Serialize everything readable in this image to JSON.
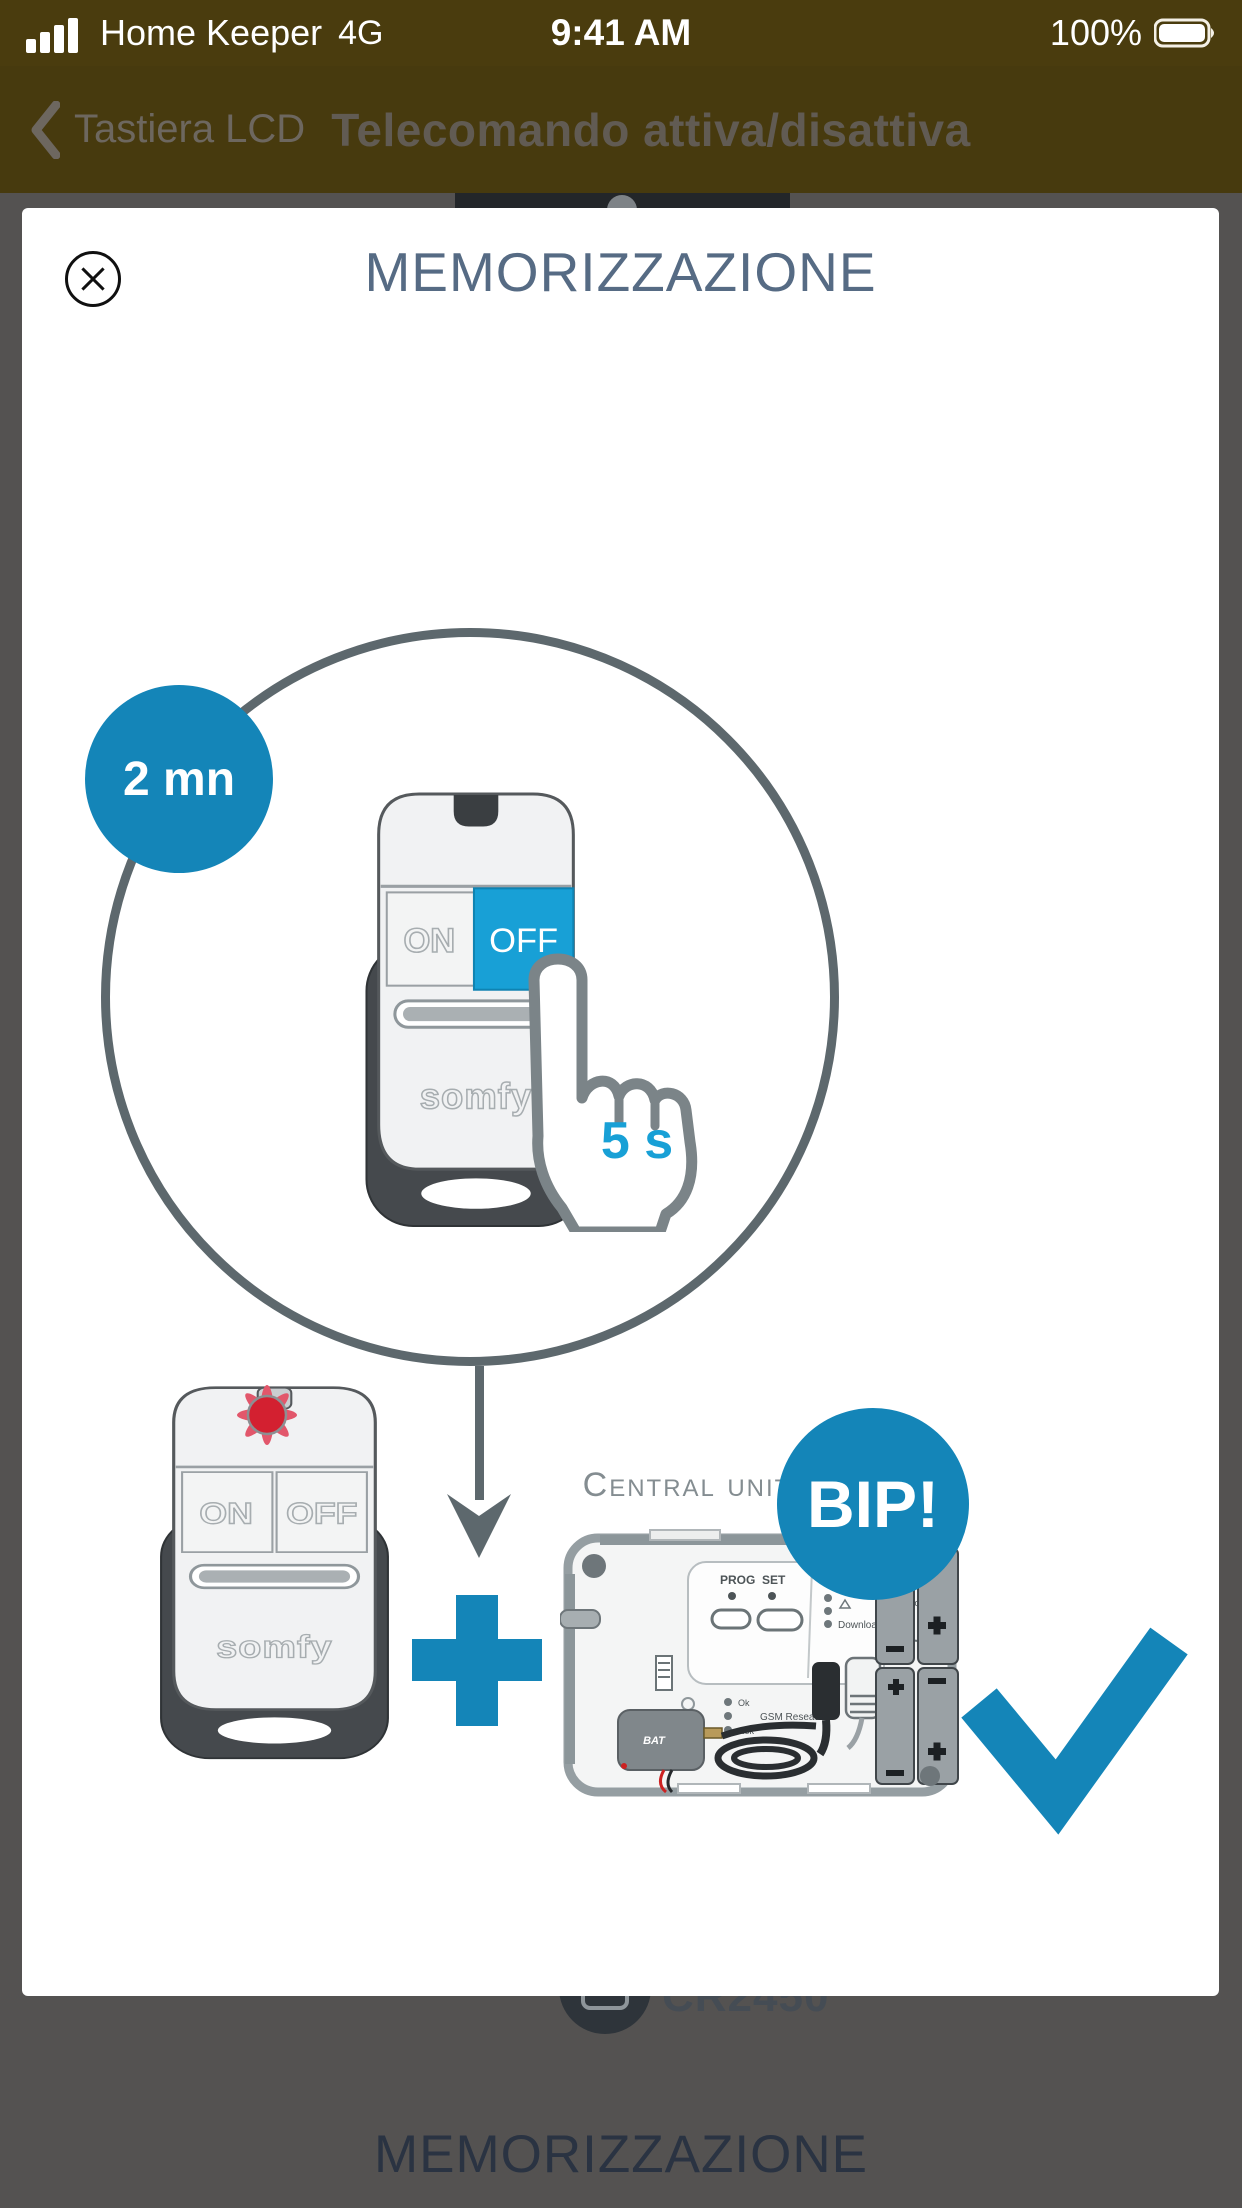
{
  "status_bar": {
    "carrier": "Home Keeper",
    "network": "4G",
    "time": "9:41 AM",
    "battery_percent": "100%"
  },
  "nav_bar": {
    "back_label": "Tastiera LCD",
    "title": "Telecomando attiva/disattiva"
  },
  "modal": {
    "title": "MEMORIZZAZIONE",
    "timer_badge": "2 mn",
    "hold_duration": "5 s",
    "remote_top": {
      "on": "ON",
      "off": "OFF",
      "brand": "somfy"
    },
    "remote_bottom": {
      "on": "ON",
      "off": "OFF",
      "brand": "somfy"
    },
    "central_unit": {
      "caption": "Central unit",
      "bip": "BIP!",
      "panel": {
        "prog": "PROG",
        "set": "SET",
        "status": "STATUS",
        "download": "Download",
        "gsm": "GSM Reseau",
        "ok": "Ok",
        "nok": "Nok",
        "bat": "BAT",
        "power": "5V"
      }
    }
  },
  "background_page": {
    "battery_model": "CR2450",
    "section_title": "MEMORIZZAZIONE"
  },
  "colors": {
    "accent_dark": "#1485b8",
    "accent_light": "#18a0d6",
    "title_navy": "#566b84",
    "ring_gray": "#5d686d",
    "olive": "#473a0e",
    "led_red": "#d32030"
  }
}
